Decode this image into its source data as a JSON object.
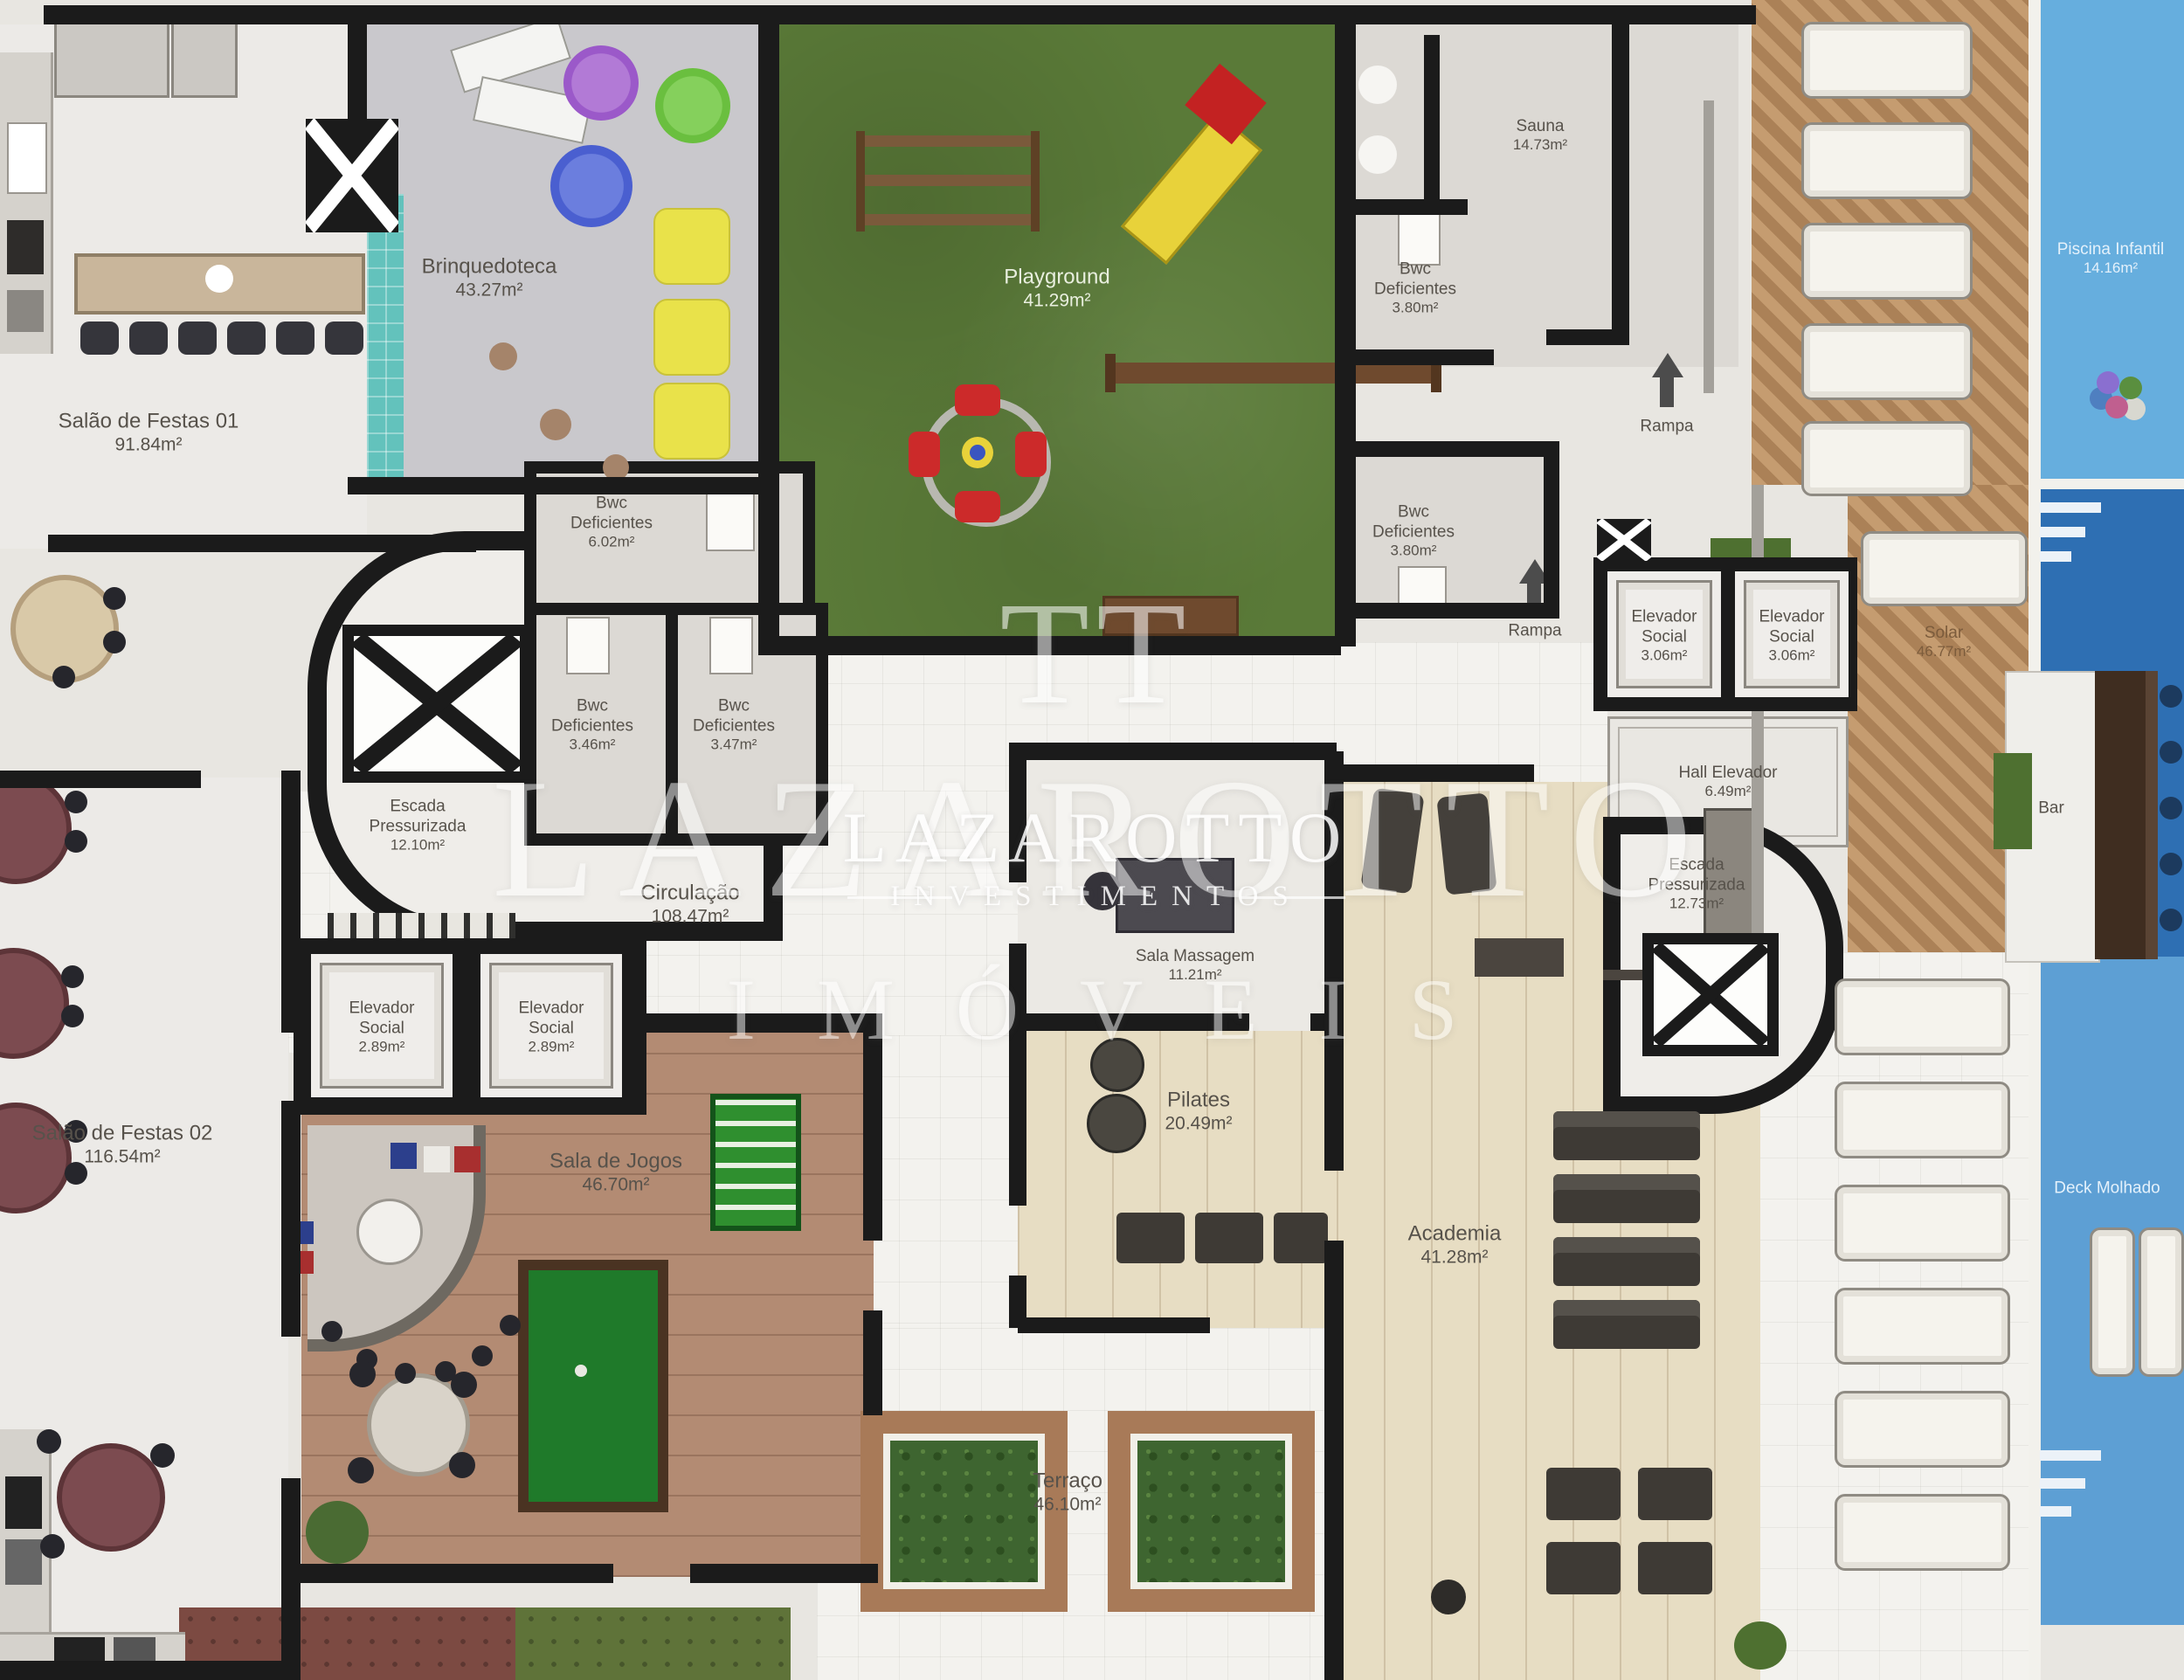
{
  "watermark": {
    "monogram": "TT",
    "brand": "LAZAROTTO",
    "inner_brand": "LAZAROTTO",
    "inner_sub": "INVESTIMENTOS",
    "imoveis": "IMÓVEIS"
  },
  "labels": {
    "salao01": {
      "name": "Salão de Festas 01",
      "area": "91.84m²"
    },
    "salao02": {
      "name": "Salão de Festas 02",
      "area": "116.54m²"
    },
    "brinquedoteca": {
      "name": "Brinquedoteca",
      "area": "43.27m²"
    },
    "playground": {
      "name": "Playground",
      "area": "41.29m²"
    },
    "sauna": {
      "name": "Sauna",
      "area": "14.73m²"
    },
    "bwc_sauna_1": {
      "name": "Bwc Deficientes",
      "area": "3.80m²"
    },
    "bwc_sauna_2": {
      "name": "Bwc Deficientes",
      "area": "3.80m²"
    },
    "bwc_center": {
      "name": "Bwc Deficientes",
      "area": "6.02m²"
    },
    "bwc_left_a": {
      "name": "Bwc Deficientes",
      "area": "3.46m²"
    },
    "bwc_left_b": {
      "name": "Bwc Deficientes",
      "area": "3.47m²"
    },
    "rampa1": {
      "name": "Rampa"
    },
    "rampa2": {
      "name": "Rampa"
    },
    "piscina_infantil": {
      "name": "Piscina Infantil",
      "area": "14.16m²"
    },
    "deck_molhado": {
      "name": "Deck Molhado"
    },
    "solar": {
      "name": "Solar",
      "area": "46.77m²"
    },
    "bar": {
      "name": "Bar"
    },
    "elev_right_1": {
      "name": "Elevador Social",
      "area": "3.06m²"
    },
    "elev_right_2": {
      "name": "Elevador Social",
      "area": "3.06m²"
    },
    "elev_left_1": {
      "name": "Elevador Social",
      "area": "2.89m²"
    },
    "elev_left_2": {
      "name": "Elevador Social",
      "area": "2.89m²"
    },
    "hall_elevador": {
      "name": "Hall Elevador",
      "area": "6.49m²"
    },
    "escada_left": {
      "name": "Escada Pressurizada",
      "area": "12.10m²"
    },
    "escada_right": {
      "name": "Escada Pressurizada",
      "area": "12.73m²"
    },
    "circulacao": {
      "name": "Circulação",
      "area": "108.47m²"
    },
    "sala_massagem": {
      "name": "Sala Massagem",
      "area": "11.21m²"
    },
    "sala_jogos": {
      "name": "Sala de Jogos",
      "area": "46.70m²"
    },
    "pilates": {
      "name": "Pilates",
      "area": "20.49m²"
    },
    "academia": {
      "name": "Academia",
      "area": "41.28m²"
    },
    "terraco": {
      "name": "Terraço",
      "area": "46.10m²"
    }
  },
  "colors": {
    "wall": "#1b1b1b",
    "grass": "#5a7a38",
    "pool_main": "#2e6fb3",
    "pool_kids": "#66aede",
    "deck_wood": "#b98a63",
    "gym_wood": "#e7ddc3",
    "game_wood": "#b38b73",
    "teal_mosaic": "#63c2bc",
    "watermark": "#ffffff"
  }
}
